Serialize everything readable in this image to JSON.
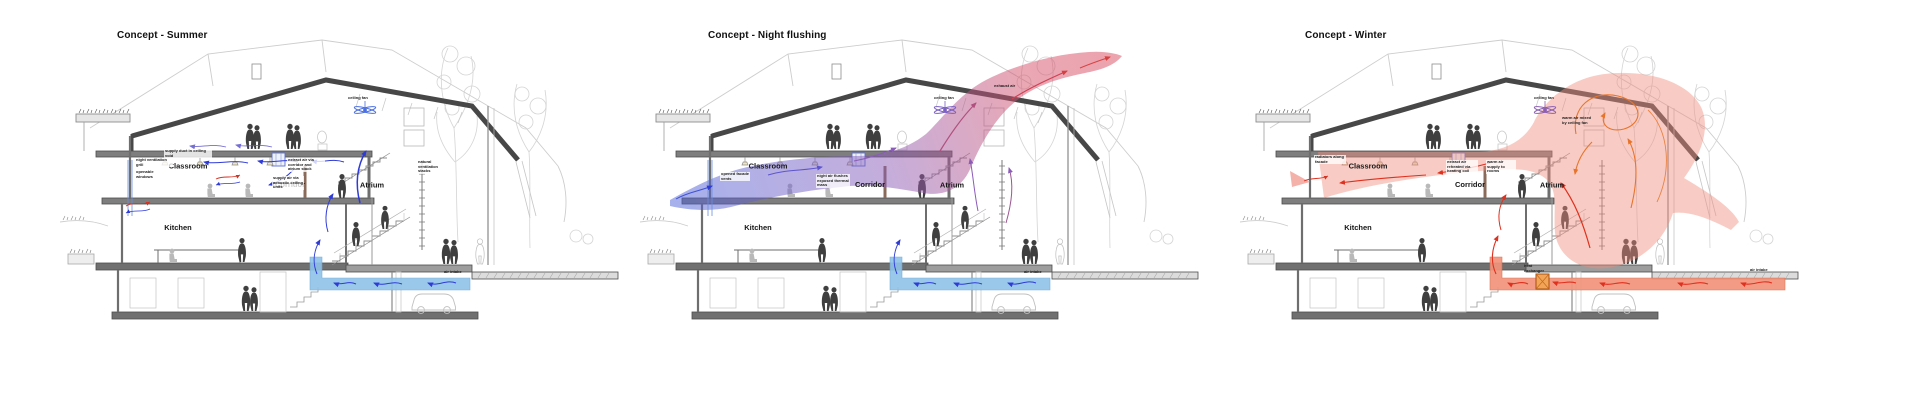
{
  "page": {
    "background_color": "#ffffff"
  },
  "colors": {
    "cool_air_flow": "#2f3bd8",
    "cool_pipe": "#8fc3e8",
    "warm_pipe": "#f2937b",
    "warm_air_flow": "#e0301e",
    "warm_air_swirl": "#e8742c",
    "warm_air_zone": "#ef8f7c",
    "night_flush_gradient_start": "#4f63d8",
    "night_flush_gradient_mid": "#8a5cb8",
    "night_flush_gradient_end": "#d4506a",
    "summer_fan": "#4a6fe0",
    "night_fan": "#7a5fc0",
    "winter_fan": "#8a5fb0",
    "structure_dark": "#474747",
    "sketch_light": "#cdcdcd"
  },
  "panels": [
    {
      "id": "summer",
      "title": "Concept - Summer",
      "rooms": {
        "classroom": "Classroom",
        "corridor": "Corridor",
        "atrium": "Atrium",
        "kitchen": "Kitchen"
      },
      "annotations": [
        "ceiling fan",
        "night ventilation grill",
        "openable windows",
        "supply duct in ceiling void",
        "extract air via corridor and atrium stack",
        "supply air via acoustic ceiling units",
        "natural ventilation stacks",
        "air intake"
      ]
    },
    {
      "id": "night-flushing",
      "title": "Concept - Night flushing",
      "rooms": {
        "classroom": "Classroom",
        "corridor": "Corridor",
        "atrium": "Atrium",
        "kitchen": "Kitchen"
      },
      "annotations": [
        "ceiling fan",
        "opened facade vents",
        "night air flushes exposed thermal mass",
        "exhaust air",
        "air intake"
      ]
    },
    {
      "id": "winter",
      "title": "Concept - Winter",
      "rooms": {
        "classroom": "Classroom",
        "corridor": "Corridor",
        "atrium": "Atrium",
        "kitchen": "Kitchen"
      },
      "annotations": [
        "ceiling fan",
        "warm air mixed by ceiling fan",
        "radiators along facade",
        "extract air reheated via heating coil",
        "warm air supply to rooms",
        "heat exchanger",
        "air intake"
      ]
    }
  ]
}
